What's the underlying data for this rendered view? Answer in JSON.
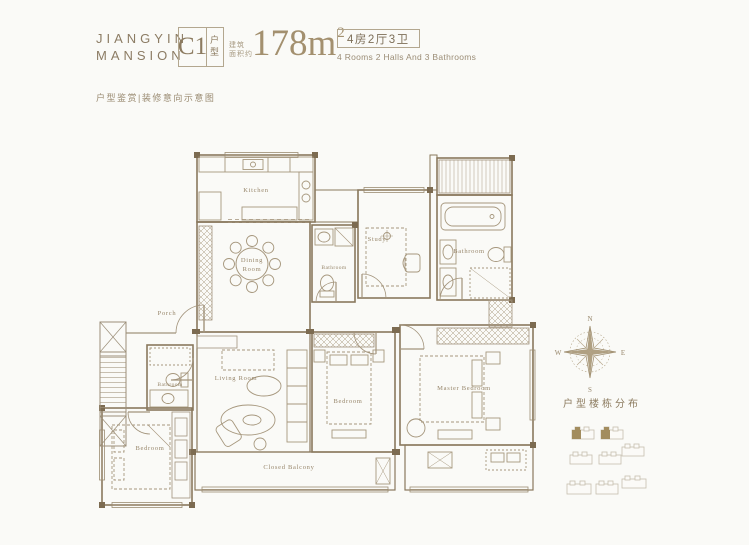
{
  "header": {
    "brand_line1": "JIANGYIN",
    "brand_line2": "MANSION",
    "unit_code": "C1",
    "unit_type": "户型",
    "area_note1": "建筑",
    "area_note2": "面积约",
    "area_value": "178m",
    "area_exp": "2",
    "config_cn": "4房2厅3卫",
    "config_en": "4 Rooms 2 Halls And 3 Bathrooms"
  },
  "subtitle": "户型鉴赏|装修意向示意图",
  "plan": {
    "kitchen": "Kitchen",
    "dining_line1": "Dining",
    "dining_line2": "Room",
    "study": "Study",
    "bath_top_right": "Bathroom",
    "bath_middle": "Bathroom",
    "bath_left": "Bathroom",
    "living": "Living Room",
    "porch": "Porch",
    "bedroom_left": "Bedroom",
    "bedroom_middle": "Bedroom",
    "master_bedroom": "Master Bedroom",
    "closed_balcony": "Closed Balcony"
  },
  "compass": {
    "n": "N",
    "e": "E",
    "s": "S",
    "w": "W"
  },
  "site_title": "户型楼栋分布",
  "colors": {
    "background": "#fafaf7",
    "accent_text": "#8c7b60",
    "area_value": "#a3906f",
    "wall_line": "#8a795e",
    "furniture_line": "#a6977d",
    "site_highlight": "#a28c5e"
  }
}
